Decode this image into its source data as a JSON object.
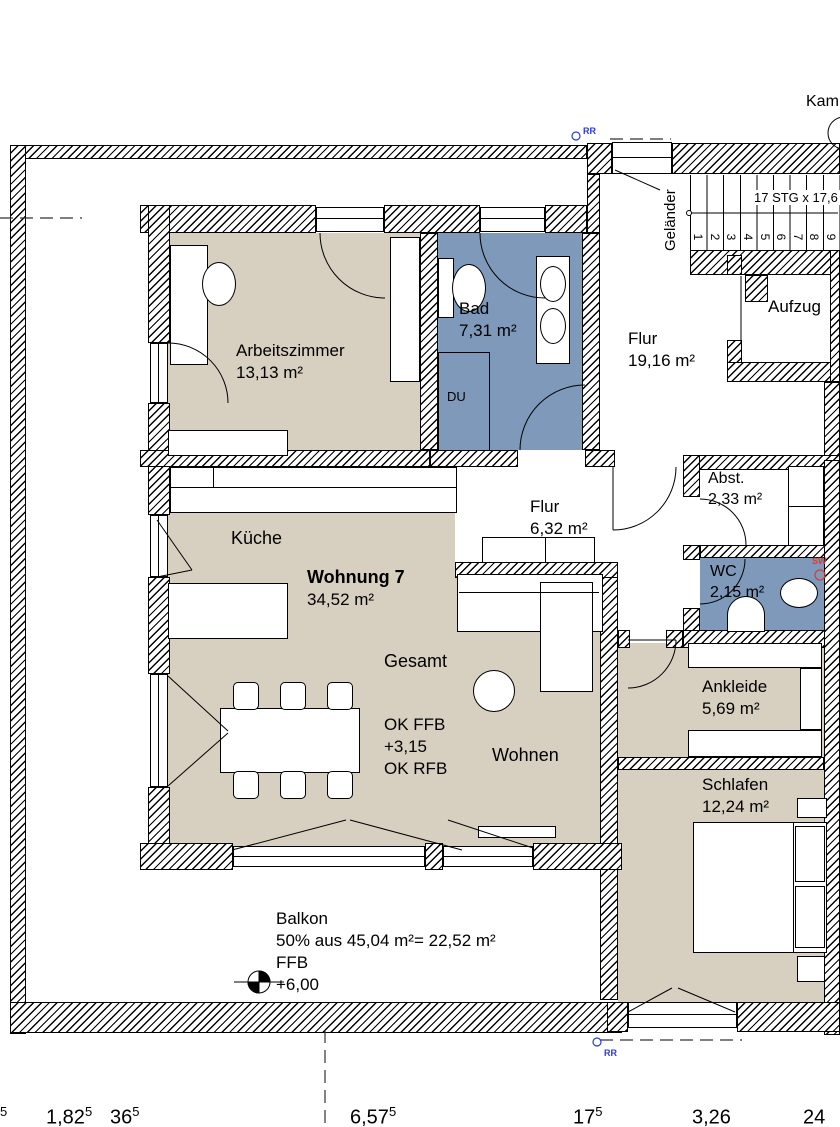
{
  "colors": {
    "beige": "#d7d0c1",
    "blue": "#7e99ba",
    "marker-blue": "#2b3bd4",
    "marker-red": "#e03a2f"
  },
  "rooms": {
    "arbeitszimmer": {
      "name": "Arbeitszimmer",
      "area": "13,13 m²"
    },
    "bad": {
      "name": "Bad",
      "area": "7,31 m²",
      "shower": "DU"
    },
    "flur_og": {
      "name": "Flur",
      "area": "19,16 m²"
    },
    "aufzug": {
      "name": "Aufzug"
    },
    "wohnung": {
      "kueche": "Küche",
      "title": "Wohnung 7",
      "area": "34,52 m²",
      "gesamt": "Gesamt",
      "ok_ffb": "OK FFB",
      "ffb_value": "+3,15",
      "ok_rfb": "OK RFB",
      "wohnen": "Wohnen"
    },
    "flur_wohnung": {
      "name": "Flur",
      "area": "6,32 m²"
    },
    "abstellraum": {
      "name": "Abst.",
      "area": "2,33 m²"
    },
    "wc": {
      "name": "WC",
      "area": "2,15 m²"
    },
    "ankleide": {
      "name": "Ankleide",
      "area": "5,69 m²"
    },
    "schlafen": {
      "name": "Schlafen",
      "area": "12,24 m²"
    },
    "balkon": {
      "name": "Balkon",
      "calc": "50% aus 45,04 m²= 22,52 m²",
      "ffb": "FFB",
      "level": "+6,00"
    }
  },
  "stairs": {
    "note": "17 STG x 17,6",
    "railing": "Geländer",
    "steps": [
      "1",
      "2",
      "3",
      "4",
      "5",
      "6",
      "7",
      "8",
      "9"
    ]
  },
  "markers": {
    "rr": "RR",
    "sw": "SW",
    "kamin": "Kam"
  },
  "dimensions": [
    {
      "v": "",
      "s": "5"
    },
    {
      "v": "1,82",
      "s": "5"
    },
    {
      "v": "36",
      "s": "5"
    },
    {
      "v": "6,57",
      "s": "5"
    },
    {
      "v": "17",
      "s": "5"
    },
    {
      "v": "3,26",
      "s": ""
    },
    {
      "v": "24",
      "s": ""
    }
  ]
}
